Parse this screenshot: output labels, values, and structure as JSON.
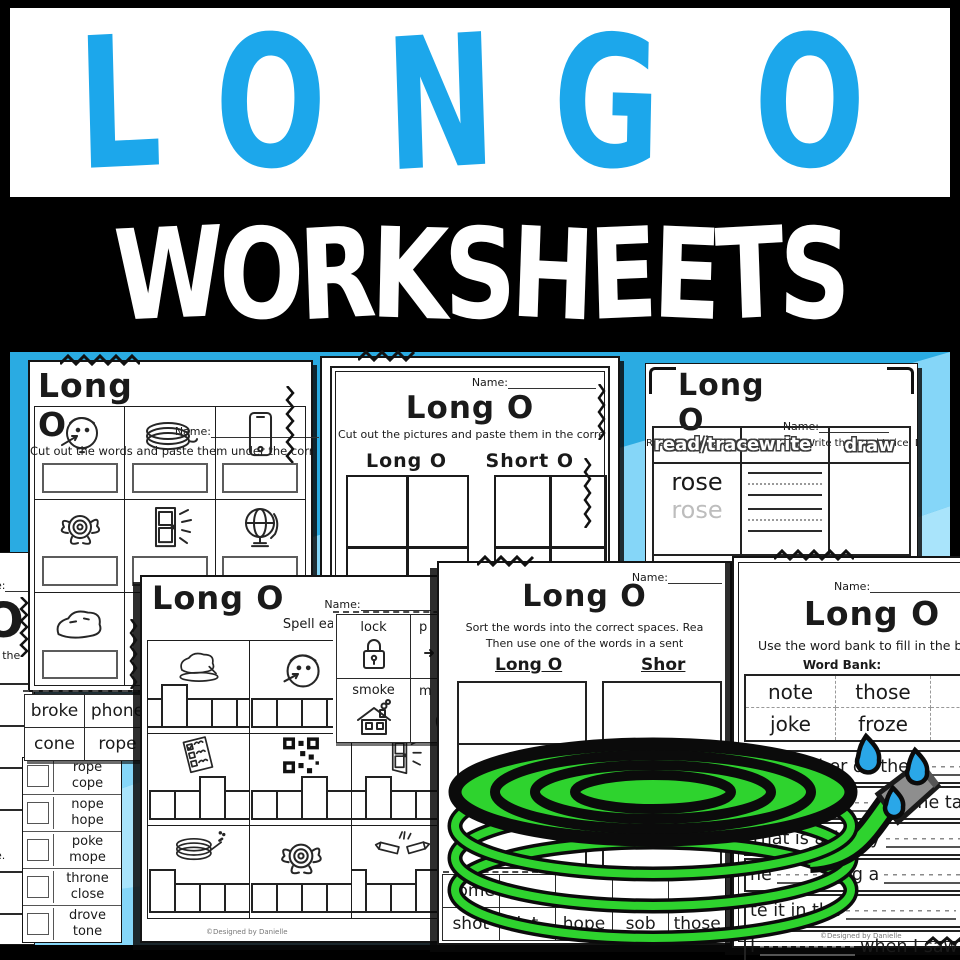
{
  "cover": {
    "title": "LONG O",
    "subtitle": "WORKSHEETS"
  },
  "colors": {
    "title_blue": "#1CA7EB",
    "background_blue": "#2AABE2",
    "background_light": "#85D6F8",
    "hose_green": "#2ED32E",
    "nozzle_gray": "#8E8E8E",
    "water_blue": "#2AA7E8"
  },
  "credit": "©Designed by Danielle",
  "cut_words": {
    "title": "Long O",
    "name_label": "Name:",
    "instruction": "Cut out the words and paste them under the correct picture.",
    "pictures": [
      "nose",
      "rope",
      "phone",
      "rose",
      "close",
      "globe",
      "stone"
    ]
  },
  "cut_pictures": {
    "title": "Long O",
    "name_label": "Name:",
    "instruction": "Cut out the pictures and paste them in the correct box.",
    "col_long": "Long O",
    "col_short": "Short O"
  },
  "picture_cards": {
    "labels": [
      "lock",
      "p",
      "smoke",
      "m"
    ]
  },
  "read_trace": {
    "title": "Long O",
    "name_label": "Name:",
    "instruction": "Read the word. Trace the word.  Write the word twice. Draw the word.",
    "headers": [
      "read/trace",
      "write",
      "draw"
    ],
    "words": [
      "rose",
      "stone",
      "note",
      "home",
      "joke"
    ]
  },
  "spell": {
    "title": "Long O",
    "name_label": "Name:",
    "instruction": "Spell each word in the bo",
    "pictures": [
      "stone",
      "nose",
      "vote",
      "code",
      "close",
      "hose",
      "rose",
      "broke"
    ]
  },
  "word_cards": {
    "cards": [
      "broke",
      "phone",
      "cone",
      "rope"
    ]
  },
  "word_list": {
    "pairs": [
      [
        "rope",
        "cope"
      ],
      [
        "nope",
        "hope"
      ],
      [
        "poke",
        "mope"
      ],
      [
        "throne",
        "close"
      ],
      [
        "drove",
        "tone"
      ]
    ]
  },
  "sort": {
    "title": "Long O",
    "name_label": "Name:",
    "instruction_1": "Sort the words into the correct spaces. Rea",
    "instruction_2": "Then use one of the words in a sent",
    "col_long": "Long O",
    "col_short": "Shor",
    "cards_row1": [
      "dome"
    ],
    "cards_row2": [
      "shot",
      "lot",
      "hope",
      "sob",
      "those"
    ]
  },
  "fill": {
    "title": "Long O",
    "name_label": "Name:",
    "instruction": "Use the word bank to fill in the blank",
    "word_bank_label": "Word Bank:",
    "bank": [
      [
        "note",
        "those",
        "ho"
      ],
      [
        "joke",
        "froze",
        "pho"
      ]
    ],
    "sentences": [
      {
        "before": "I called her on the",
        "after": ""
      },
      {
        "before": "Put",
        "after": "on the table"
      },
      {
        "before": "That is a funny",
        "after": ""
      },
      {
        "before": "he",
        "after": "g a"
      },
      {
        "before": "te it in the",
        "after": "."
      },
      {
        "before": "I",
        "after": "when I saw a b"
      }
    ]
  },
  "left_partial": {
    "name_fragment": "e:",
    "title_fragment": "O",
    "instruction_fragment": "s the",
    "line_fragment": "e."
  }
}
